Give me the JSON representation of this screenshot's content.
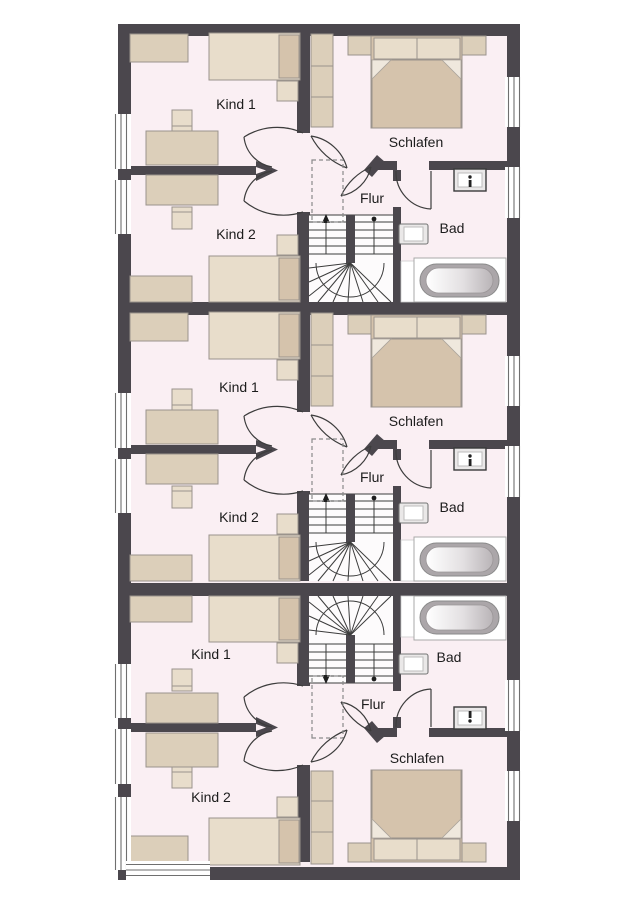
{
  "plan": {
    "type": "residential-floor-plan",
    "units_count": 3
  },
  "colors": {
    "wall": "#4b474d",
    "floor": "#faeff3",
    "furniture": "#dccfba",
    "furniture_light": "#e8ddcb",
    "furniture_dark": "#d5c3ac",
    "stair_background": "#fdfbfc",
    "bathtub_gray": "#aba6a9",
    "label_text": "#1c1c1c"
  },
  "units": [
    {
      "name": "unit-top",
      "rooms": {
        "kind1": "Kind 1",
        "kind2": "Kind 2",
        "schlafen": "Schlafen",
        "flur": "Flur",
        "bad": "Bad"
      }
    },
    {
      "name": "unit-middle",
      "rooms": {
        "kind1": "Kind 1",
        "kind2": "Kind 2",
        "schlafen": "Schlafen",
        "flur": "Flur",
        "bad": "Bad"
      }
    },
    {
      "name": "unit-bottom",
      "rooms": {
        "kind1": "Kind 1",
        "kind2": "Kind 2",
        "schlafen": "Schlafen",
        "flur": "Flur",
        "bad": "Bad"
      }
    }
  ]
}
